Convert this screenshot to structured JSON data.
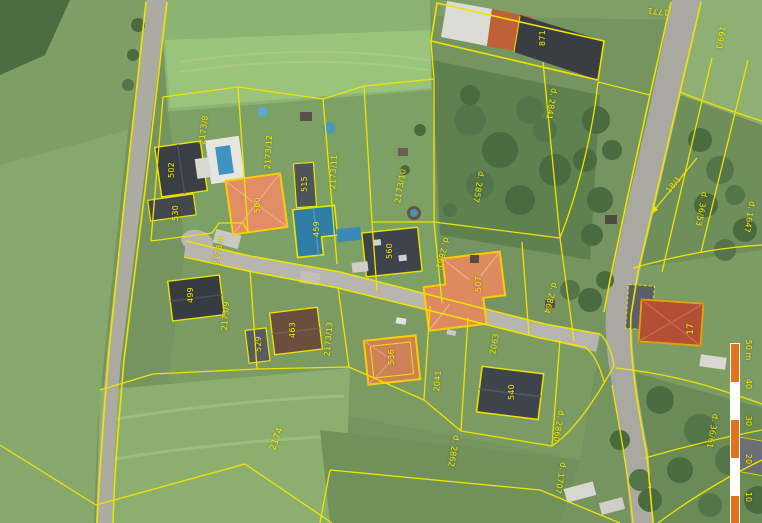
{
  "map": {
    "description": "Cadastral parcel map overlaid on aerial orthophoto",
    "colors": {
      "parcel_line": "#f0e300",
      "highlight_outline": "#ffcc00",
      "label_text": "#f6ef00",
      "scale_orange": "#e4721c",
      "scale_white": "#ffffff"
    }
  },
  "parcel_labels": [
    {
      "text": "502",
      "x": 172,
      "y": 170,
      "rot": -90
    },
    {
      "text": "2173/8",
      "x": 204,
      "y": 130,
      "rot": -83
    },
    {
      "text": "530",
      "x": 176,
      "y": 213,
      "rot": -90
    },
    {
      "text": "2173/12",
      "x": 269,
      "y": 152,
      "rot": -87
    },
    {
      "text": "500",
      "x": 258,
      "y": 205,
      "rot": -90
    },
    {
      "text": "515",
      "x": 305,
      "y": 184,
      "rot": -90
    },
    {
      "text": "2173/11",
      "x": 334,
      "y": 172,
      "rot": -87
    },
    {
      "text": "459",
      "x": 317,
      "y": 229,
      "rot": -90
    },
    {
      "text": "2173/10",
      "x": 401,
      "y": 186,
      "rot": -80
    },
    {
      "text": "560",
      "x": 390,
      "y": 251,
      "rot": -90
    },
    {
      "text": "2857",
      "prefix": "d.",
      "x": 478,
      "y": 187,
      "rot": 100
    },
    {
      "text": "871",
      "x": 543,
      "y": 38,
      "rot": -90
    },
    {
      "text": "2841",
      "prefix": "d.",
      "x": 551,
      "y": 104,
      "rot": 100
    },
    {
      "text": "1771",
      "x": 658,
      "y": 11,
      "rot": 186
    },
    {
      "text": "169/1",
      "x": 720,
      "y": 38,
      "rot": 100
    },
    {
      "text": "18/1",
      "x": 674,
      "y": 185,
      "rot": -50
    },
    {
      "text": "36/53",
      "prefix": "d.",
      "x": 701,
      "y": 209,
      "rot": 100
    },
    {
      "text": "1647",
      "prefix": "d.",
      "x": 749,
      "y": 217,
      "rot": 100
    },
    {
      "text": "17",
      "x": 691,
      "y": 329,
      "rot": -90,
      "big": true
    },
    {
      "text": "36/61",
      "prefix": "d.",
      "x": 712,
      "y": 431,
      "rot": 100
    },
    {
      "text": "2173/4",
      "x": 219,
      "y": 251,
      "rot": -78
    },
    {
      "text": "499",
      "x": 191,
      "y": 295,
      "rot": -90
    },
    {
      "text": "2173/9",
      "x": 226,
      "y": 316,
      "rot": -85
    },
    {
      "text": "463",
      "x": 293,
      "y": 330,
      "rot": -90
    },
    {
      "text": "529",
      "x": 259,
      "y": 344,
      "rot": -90
    },
    {
      "text": "2173/13",
      "x": 329,
      "y": 339,
      "rot": -85
    },
    {
      "text": "2861",
      "prefix": "d.",
      "x": 442,
      "y": 253,
      "rot": 105
    },
    {
      "text": "507",
      "x": 479,
      "y": 284,
      "rot": -90
    },
    {
      "text": "2864",
      "prefix": "d.",
      "x": 550,
      "y": 298,
      "rot": 105
    },
    {
      "text": "536",
      "x": 392,
      "y": 357,
      "rot": -90
    },
    {
      "text": "2041",
      "x": 438,
      "y": 381,
      "rot": -85
    },
    {
      "text": "540",
      "x": 512,
      "y": 392,
      "rot": -90
    },
    {
      "text": "2063",
      "x": 495,
      "y": 344,
      "rot": -80
    },
    {
      "text": "2862",
      "prefix": "d.",
      "x": 453,
      "y": 451,
      "rot": 100
    },
    {
      "text": "2860",
      "prefix": "d.",
      "x": 558,
      "y": 426,
      "rot": 100
    },
    {
      "text": "1707",
      "prefix": "d.",
      "x": 560,
      "y": 478,
      "rot": 100
    },
    {
      "text": "2174",
      "x": 277,
      "y": 439,
      "rot": -70,
      "big": true
    }
  ],
  "scale_bar": {
    "orientation": "vertical",
    "x": 731,
    "top": 344,
    "width_px": 8,
    "segment_px": 38,
    "segments": 5,
    "ticks": [
      {
        "text": "50 m",
        "y": 350
      },
      {
        "text": "40",
        "y": 384
      },
      {
        "text": "30",
        "y": 421
      },
      {
        "text": "20",
        "y": 459
      },
      {
        "text": "10",
        "y": 497
      }
    ]
  }
}
